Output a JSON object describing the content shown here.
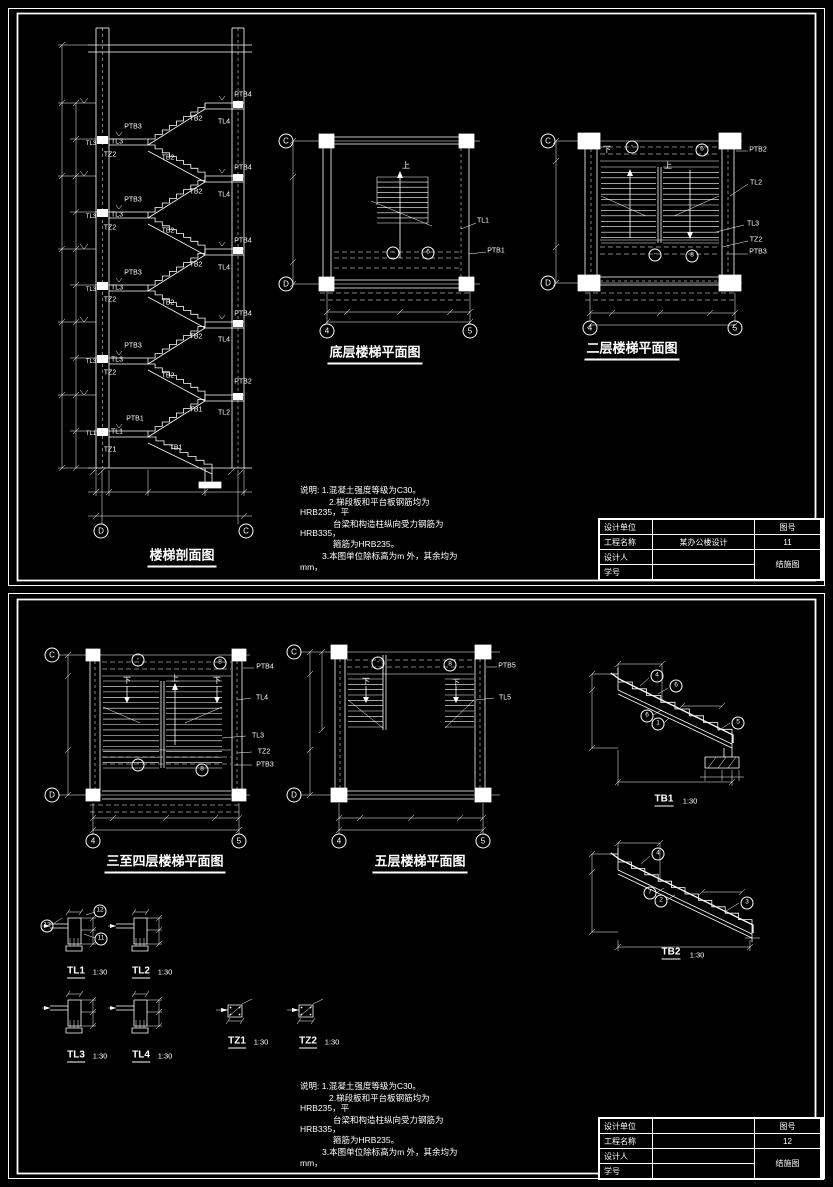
{
  "colors": {
    "background": "#000000",
    "line": "#ffffff"
  },
  "sheet1": {
    "section": {
      "title": "楼梯剖面图",
      "labels": [
        {
          "t": "PTB4",
          "x": 243,
          "y": 95
        },
        {
          "t": "PTB4",
          "x": 243,
          "y": 168
        },
        {
          "t": "PTB4",
          "x": 243,
          "y": 241
        },
        {
          "t": "PTB4",
          "x": 243,
          "y": 314
        },
        {
          "t": "PTB2",
          "x": 243,
          "y": 382
        },
        {
          "t": "TL4",
          "x": 224,
          "y": 122
        },
        {
          "t": "TL4",
          "x": 224,
          "y": 195
        },
        {
          "t": "TL4",
          "x": 224,
          "y": 268
        },
        {
          "t": "TL4",
          "x": 224,
          "y": 340
        },
        {
          "t": "TL2",
          "x": 224,
          "y": 413
        },
        {
          "t": "TB2",
          "x": 196,
          "y": 119
        },
        {
          "t": "TB2",
          "x": 196,
          "y": 192
        },
        {
          "t": "TB2",
          "x": 196,
          "y": 265
        },
        {
          "t": "TB2",
          "x": 196,
          "y": 337
        },
        {
          "t": "TB1",
          "x": 196,
          "y": 410
        },
        {
          "t": "TB2",
          "x": 168,
          "y": 158
        },
        {
          "t": "TB2",
          "x": 168,
          "y": 231
        },
        {
          "t": "TB2",
          "x": 168,
          "y": 303
        },
        {
          "t": "TB2",
          "x": 168,
          "y": 376
        },
        {
          "t": "TB1",
          "x": 176,
          "y": 448
        },
        {
          "t": "PTB3",
          "x": 133,
          "y": 127
        },
        {
          "t": "PTB3",
          "x": 133,
          "y": 200
        },
        {
          "t": "PTB3",
          "x": 133,
          "y": 273
        },
        {
          "t": "PTB3",
          "x": 133,
          "y": 346
        },
        {
          "t": "PTB1",
          "x": 135,
          "y": 419
        },
        {
          "t": "TL3",
          "x": 117,
          "y": 142
        },
        {
          "t": "TL3",
          "x": 117,
          "y": 215
        },
        {
          "t": "TL3",
          "x": 117,
          "y": 288
        },
        {
          "t": "TL3",
          "x": 117,
          "y": 360
        },
        {
          "t": "TL1",
          "x": 117,
          "y": 432
        },
        {
          "t": "TZ2",
          "x": 110,
          "y": 155
        },
        {
          "t": "TZ2",
          "x": 110,
          "y": 228
        },
        {
          "t": "TZ2",
          "x": 110,
          "y": 300
        },
        {
          "t": "TZ2",
          "x": 110,
          "y": 373
        },
        {
          "t": "TZ1",
          "x": 110,
          "y": 450
        },
        {
          "t": "TL3",
          "x": 91,
          "y": 144,
          "c": "s6"
        },
        {
          "t": "TL3",
          "x": 91,
          "y": 217,
          "c": "s6"
        },
        {
          "t": "TL3",
          "x": 91,
          "y": 290,
          "c": "s6"
        },
        {
          "t": "TL3",
          "x": 91,
          "y": 362,
          "c": "s6"
        },
        {
          "t": "TL1",
          "x": 91,
          "y": 434,
          "c": "s6"
        },
        {
          "t": "D",
          "x": 101,
          "y": 531,
          "c": "bub"
        },
        {
          "t": "C",
          "x": 246,
          "y": 531,
          "c": "bub"
        }
      ]
    },
    "plan_ground": {
      "title": "底层楼梯平面图",
      "labels": [
        {
          "t": "TL1",
          "x": 483,
          "y": 221
        },
        {
          "t": "PTB1",
          "x": 496,
          "y": 251
        },
        {
          "t": "6",
          "x": 428,
          "y": 253,
          "c": "circ"
        },
        {
          "t": "-",
          "x": 393,
          "y": 253,
          "c": "circ"
        },
        {
          "t": "上",
          "x": 406,
          "y": 166,
          "c": "cn"
        },
        {
          "t": "C",
          "x": 286,
          "y": 141,
          "c": "bub"
        },
        {
          "t": "D",
          "x": 286,
          "y": 284,
          "c": "bub"
        },
        {
          "t": "4",
          "x": 327,
          "y": 331,
          "c": "bub"
        },
        {
          "t": "5",
          "x": 470,
          "y": 331,
          "c": "bub"
        }
      ]
    },
    "plan_second": {
      "title": "二层楼梯平面图",
      "labels": [
        {
          "t": "PTB2",
          "x": 758,
          "y": 150
        },
        {
          "t": "TL2",
          "x": 756,
          "y": 183
        },
        {
          "t": "TL3",
          "x": 753,
          "y": 224
        },
        {
          "t": "TZ2",
          "x": 756,
          "y": 240
        },
        {
          "t": "PTB3",
          "x": 758,
          "y": 252
        },
        {
          "t": "-",
          "x": 632,
          "y": 147,
          "c": "circ"
        },
        {
          "t": "6",
          "x": 702,
          "y": 150,
          "c": "circ"
        },
        {
          "t": "-",
          "x": 655,
          "y": 255,
          "c": "circ"
        },
        {
          "t": "8",
          "x": 692,
          "y": 256,
          "c": "circ"
        },
        {
          "t": "下",
          "x": 607,
          "y": 150,
          "c": "cn"
        },
        {
          "t": "上",
          "x": 668,
          "y": 166,
          "c": "cn"
        },
        {
          "t": "C",
          "x": 548,
          "y": 141,
          "c": "bub"
        },
        {
          "t": "D",
          "x": 548,
          "y": 283,
          "c": "bub"
        },
        {
          "t": "4",
          "x": 590,
          "y": 328,
          "c": "bub"
        },
        {
          "t": "5",
          "x": 735,
          "y": 328,
          "c": "bub"
        }
      ]
    },
    "notes": {
      "labels": [
        {
          "t": "说明: 1.混凝土强度等级为C30。",
          "x": 300,
          "y": 490,
          "c": "note"
        },
        {
          "t": "2.梯段板和平台板钢筋均为",
          "x": 329,
          "y": 502,
          "c": "note"
        },
        {
          "t": "HRB235，平",
          "x": 300,
          "y": 512,
          "c": "note"
        },
        {
          "t": "台梁和构造柱纵向受力钢筋为",
          "x": 333,
          "y": 524,
          "c": "note"
        },
        {
          "t": "HRB335，",
          "x": 300,
          "y": 533,
          "c": "note"
        },
        {
          "t": "箍筋为HRB235。",
          "x": 333,
          "y": 544,
          "c": "note"
        },
        {
          "t": "3.本图单位除标高为m 外，其余均为",
          "x": 322,
          "y": 556,
          "c": "note"
        },
        {
          "t": "mm，",
          "x": 300,
          "y": 567,
          "c": "note"
        }
      ]
    },
    "titleblock": {
      "rows": [
        [
          "设计单位",
          ""
        ],
        [
          "工程名称",
          "某办公楼设计"
        ],
        [
          "设计人",
          ""
        ],
        [
          "学号",
          ""
        ]
      ],
      "fig_label": "图号",
      "fig_no": "11",
      "doc_type": "结施图"
    }
  },
  "sheet2": {
    "plan_3to4": {
      "title": "三至四层楼梯平面图",
      "labels": [
        {
          "t": "PTB4",
          "x": 265,
          "y": 667
        },
        {
          "t": "TL4",
          "x": 262,
          "y": 698
        },
        {
          "t": "TL3",
          "x": 258,
          "y": 736
        },
        {
          "t": "TZ2",
          "x": 264,
          "y": 752
        },
        {
          "t": "PTB3",
          "x": 265,
          "y": 765
        },
        {
          "t": "-",
          "x": 138,
          "y": 660,
          "c": "circ"
        },
        {
          "t": "8",
          "x": 220,
          "y": 663,
          "c": "circ"
        },
        {
          "t": "-",
          "x": 138,
          "y": 765,
          "c": "circ"
        },
        {
          "t": "8",
          "x": 202,
          "y": 770,
          "c": "circ"
        },
        {
          "t": "下",
          "x": 127,
          "y": 681,
          "c": "cn"
        },
        {
          "t": "上",
          "x": 175,
          "y": 679,
          "c": "cn"
        },
        {
          "t": "下",
          "x": 217,
          "y": 681,
          "c": "cn"
        },
        {
          "t": "C",
          "x": 52,
          "y": 655,
          "c": "bub"
        },
        {
          "t": "D",
          "x": 52,
          "y": 795,
          "c": "bub"
        },
        {
          "t": "4",
          "x": 93,
          "y": 841,
          "c": "bub"
        },
        {
          "t": "5",
          "x": 239,
          "y": 841,
          "c": "bub"
        }
      ]
    },
    "plan_fifth": {
      "title": "五层楼梯平面图",
      "labels": [
        {
          "t": "PTB5",
          "x": 507,
          "y": 666
        },
        {
          "t": "TL5",
          "x": 505,
          "y": 698
        },
        {
          "t": "-",
          "x": 378,
          "y": 663,
          "c": "circ"
        },
        {
          "t": "8",
          "x": 450,
          "y": 665,
          "c": "circ"
        },
        {
          "t": "下",
          "x": 366,
          "y": 682,
          "c": "cn"
        },
        {
          "t": "下",
          "x": 456,
          "y": 683,
          "c": "cn"
        },
        {
          "t": "C",
          "x": 294,
          "y": 652,
          "c": "bub"
        },
        {
          "t": "D",
          "x": 294,
          "y": 795,
          "c": "bub"
        },
        {
          "t": "4",
          "x": 339,
          "y": 841,
          "c": "bub"
        },
        {
          "t": "5",
          "x": 483,
          "y": 841,
          "c": "bub"
        }
      ]
    },
    "detail_tb1": {
      "title": "TB1",
      "scale": "1:30",
      "marks": [
        {
          "t": "4",
          "x": 657,
          "y": 676,
          "c": "circ"
        },
        {
          "t": "6",
          "x": 676,
          "y": 686,
          "c": "circ"
        },
        {
          "t": "6",
          "x": 647,
          "y": 716,
          "c": "circ"
        },
        {
          "t": "1",
          "x": 658,
          "y": 724,
          "c": "circ"
        },
        {
          "t": "5",
          "x": 738,
          "y": 723,
          "c": "circ"
        }
      ]
    },
    "detail_tb2": {
      "title": "TB2",
      "scale": "1:30",
      "marks": [
        {
          "t": "4",
          "x": 658,
          "y": 854,
          "c": "circ"
        },
        {
          "t": "7",
          "x": 650,
          "y": 893,
          "c": "circ"
        },
        {
          "t": "2",
          "x": 661,
          "y": 901,
          "c": "circ"
        },
        {
          "t": "3",
          "x": 747,
          "y": 903,
          "c": "circ"
        }
      ]
    },
    "beam_sections": [
      {
        "title": "TL1",
        "scale": "1:30"
      },
      {
        "title": "TL2",
        "scale": "1:30"
      },
      {
        "title": "TL3",
        "scale": "1:30"
      },
      {
        "title": "TL4",
        "scale": "1:30"
      }
    ],
    "beam_section_marks": [
      {
        "t": "13",
        "x": 47,
        "y": 926,
        "c": "circ"
      },
      {
        "t": "12",
        "x": 100,
        "y": 911,
        "c": "circ"
      },
      {
        "t": "11",
        "x": 101,
        "y": 939,
        "c": "circ"
      }
    ],
    "column_sections": [
      {
        "title": "TZ1",
        "scale": "1:30"
      },
      {
        "title": "TZ2",
        "scale": "1:30"
      }
    ],
    "notes": {
      "labels": [
        {
          "t": "说明: 1.混凝土强度等级为C30。",
          "x": 300,
          "y": 1086,
          "c": "note"
        },
        {
          "t": "2.梯段板和平台板钢筋均为",
          "x": 329,
          "y": 1098,
          "c": "note"
        },
        {
          "t": "HRB235，平",
          "x": 300,
          "y": 1108,
          "c": "note"
        },
        {
          "t": "台梁和构造柱纵向受力钢筋为",
          "x": 333,
          "y": 1120,
          "c": "note"
        },
        {
          "t": "HRB335，",
          "x": 300,
          "y": 1129,
          "c": "note"
        },
        {
          "t": "箍筋为HRB235。",
          "x": 333,
          "y": 1140,
          "c": "note"
        },
        {
          "t": "3.本图单位除标高为m 外，其余均为",
          "x": 322,
          "y": 1152,
          "c": "note"
        },
        {
          "t": "mm，",
          "x": 300,
          "y": 1163,
          "c": "note"
        }
      ]
    },
    "titleblock": {
      "rows": [
        [
          "设计单位",
          ""
        ],
        [
          "工程名称",
          ""
        ],
        [
          "设计人",
          ""
        ],
        [
          "学号",
          ""
        ]
      ],
      "fig_label": "图号",
      "fig_no": "12",
      "doc_type": "结施图"
    }
  }
}
